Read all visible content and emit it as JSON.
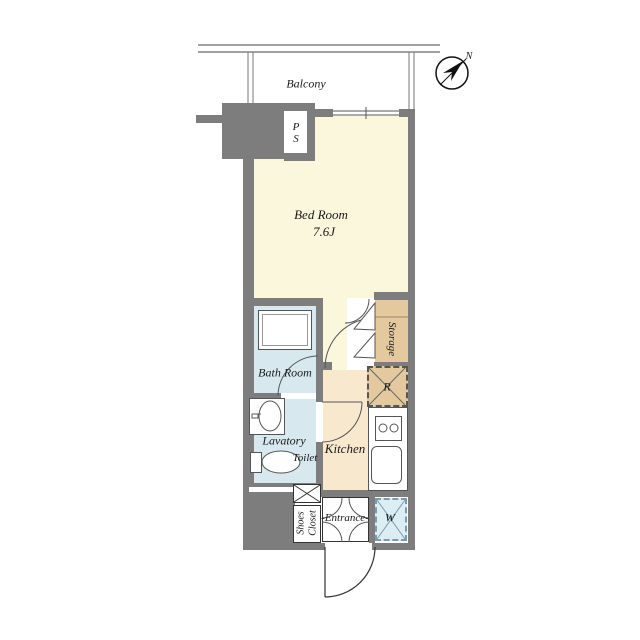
{
  "plan_title": "studio apartment floor plan",
  "compass": {
    "north_label": "N"
  },
  "balcony": {
    "label": "Balcony"
  },
  "rooms": {
    "bedroom": {
      "name": "Bed Room",
      "size": "7.6J"
    },
    "bathroom": {
      "name": "Bath Room"
    },
    "lavatory": {
      "name": "Lavatory"
    },
    "toilet": {
      "name": "Toilet"
    },
    "kitchen": {
      "name": "Kitchen"
    },
    "storage": {
      "name": "Storage"
    },
    "shoes_closet": {
      "name": "Shoes\nCloset"
    },
    "entrance": {
      "name": "-Entrance-"
    }
  },
  "fixtures": {
    "pipe_space_label": "P\nS",
    "refrigerator_label": "R",
    "washer_label": "W"
  },
  "colors": {
    "wall": "#7d7d7d",
    "bedroom_floor": "#faf7dc",
    "wet_area_floor": "#d7e9ef",
    "kitchen_floor": "#f8e9ce",
    "storage_floor": "#e4c99e",
    "washer_area": "#dceef4",
    "line": "#555555"
  }
}
